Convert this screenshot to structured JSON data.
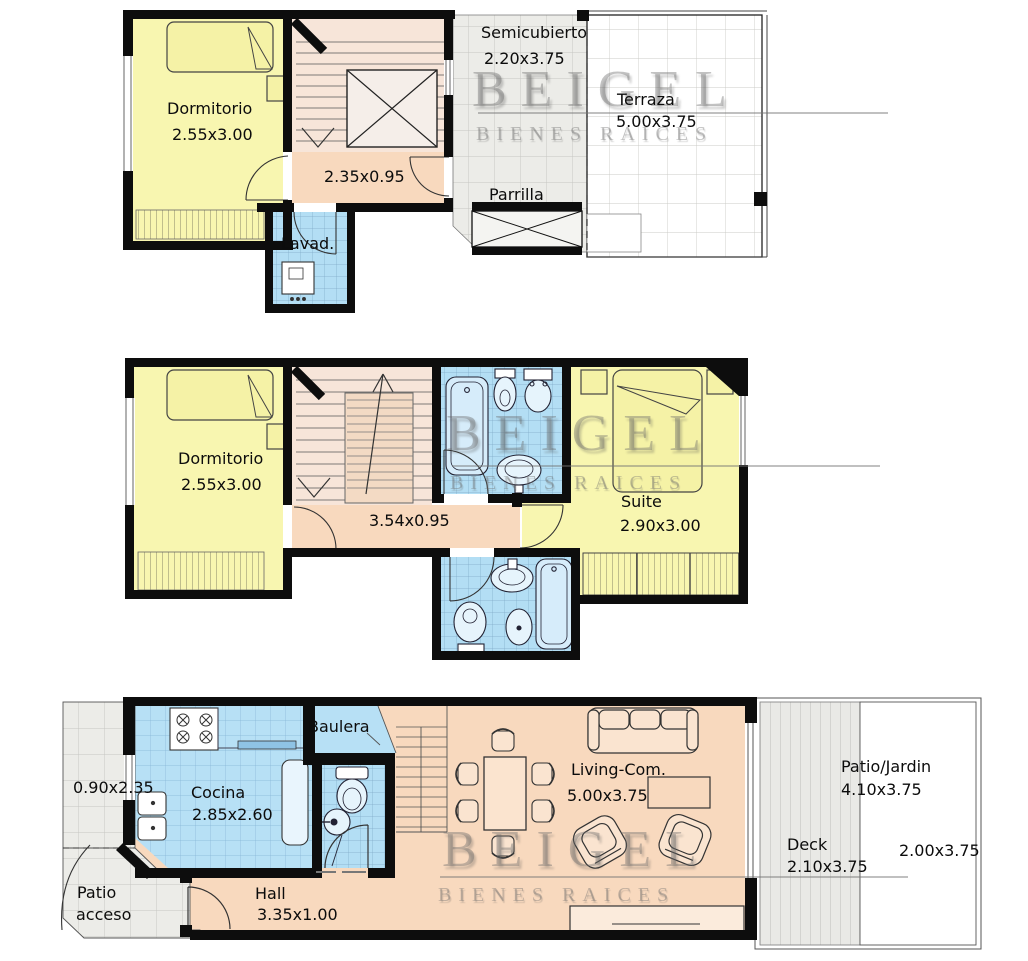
{
  "watermark": {
    "brand": "BEIGEL",
    "tagline": "BIENES RAICES"
  },
  "upper_floor": {
    "dormitorio": {
      "name": "Dormitorio",
      "dim": "2.55x3.00"
    },
    "pasillo_dim": "2.35x0.95",
    "lavadero": "Lavad.",
    "semicubierto": {
      "name": "Semicubierto",
      "dim": "2.20x3.75"
    },
    "terraza": {
      "name": "Terraza",
      "dim": "5.00x3.75"
    },
    "parrilla": "Parrilla"
  },
  "middle_floor": {
    "dormitorio": {
      "name": "Dormitorio",
      "dim": "2.55x3.00"
    },
    "pasillo_dim": "3.54x0.95",
    "suite": {
      "name": "Suite",
      "dim": "2.90x3.00"
    }
  },
  "ground_floor": {
    "patio_lateral_dim": "0.90x2.35",
    "patio_acceso": {
      "line1": "Patio",
      "line2": "acceso"
    },
    "cocina": {
      "name": "Cocina",
      "dim": "2.85x2.60"
    },
    "baulera": "Baulera",
    "hall": {
      "name": "Hall",
      "dim": "3.35x1.00"
    },
    "living": {
      "name": "Living-Com.",
      "dim": "5.00x3.75"
    },
    "patio_jardin": {
      "name": "Patio/Jardin",
      "dim": "4.10x3.75",
      "sub_dim": "2.00x3.75"
    },
    "deck": {
      "name": "Deck",
      "dim": "2.10x3.75"
    }
  },
  "colors": {
    "walls": "#0d0d0d",
    "bedrooms": "#F8F6B0",
    "wet_areas": "#B3DEF4",
    "circulation": "#F8D9BE",
    "stairs": "#F7E5D9",
    "outdoor_gray": "#ECECE8",
    "terrace": "#FFFFFF",
    "watermark": "#9A9A9A"
  }
}
